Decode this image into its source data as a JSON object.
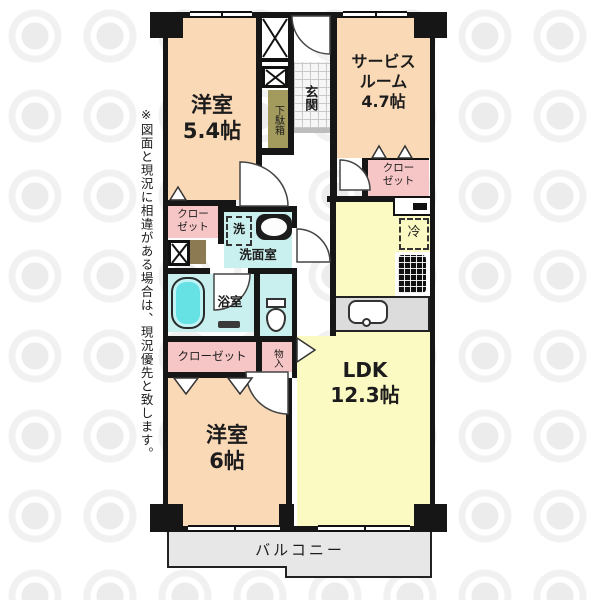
{
  "plan": {
    "rooms": {
      "western_room_1": {
        "name": "洋室",
        "size": "5.4帖"
      },
      "service_room": {
        "name_line1": "サービス",
        "name_line2": "ルーム",
        "size": "4.7帖"
      },
      "ldk": {
        "name": "LDK",
        "size": "12.3帖"
      },
      "western_room_2": {
        "name": "洋室",
        "size": "6帖"
      }
    },
    "labels": {
      "entrance": "玄関",
      "shoe_cabinet": "下駄箱",
      "closet_line1": "クロー",
      "closet_line2": "ゼット",
      "closet": "クローゼット",
      "storage": "物入",
      "washroom": "洗面室",
      "washer": "洗",
      "bathroom": "浴室",
      "fridge": "冷",
      "balcony": "バルコニー"
    },
    "disclaimer": "※図面と現況に相違がある場合は、現況優先と致します。"
  },
  "colors": {
    "wall": "#161616",
    "peach": "#FAD9B6",
    "yellow": "#FBFAC3",
    "pink": "#F6C5C5",
    "cyan": "#C9F0EE",
    "tub": "#66E2E4",
    "olive": "#A39A5E",
    "olive2": "#8C7B52",
    "counter": "#DCDCDC",
    "balcony": "#E7E7E7"
  }
}
